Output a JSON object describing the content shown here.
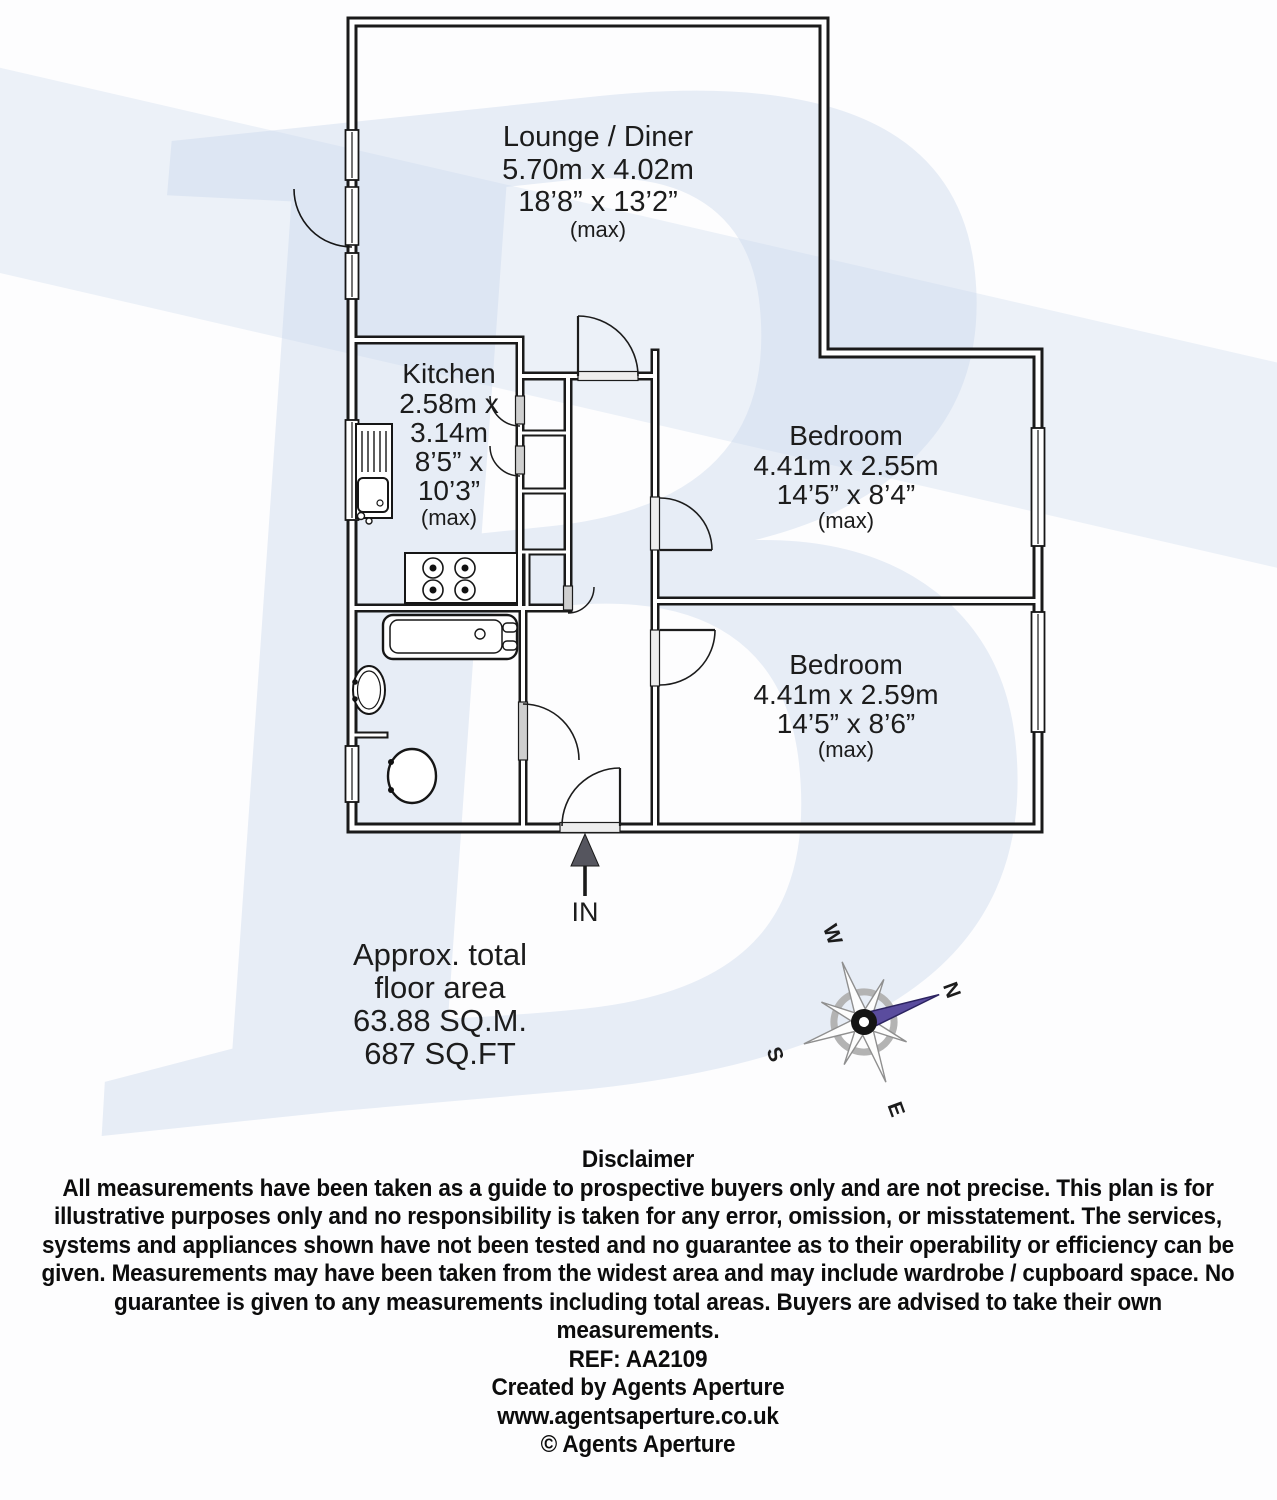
{
  "watermark": {
    "letter": "B"
  },
  "plan": {
    "rooms": {
      "lounge": {
        "name": "Lounge / Diner",
        "metric": "5.70m x 4.02m",
        "imperial": "18’8” x 13’2”",
        "max": "(max)"
      },
      "kitchen": {
        "name": "Kitchen",
        "metric_1": "2.58m x",
        "metric_2": "3.14m",
        "imperial_1": "8’5” x",
        "imperial_2": "10’3”",
        "max": "(max)"
      },
      "bedroom1": {
        "name": "Bedroom",
        "metric": "4.41m x 2.55m",
        "imperial": "14’5” x 8’4”",
        "max": "(max)"
      },
      "bedroom2": {
        "name": "Bedroom",
        "metric": "4.41m x 2.59m",
        "imperial": "14’5” x 8’6”",
        "max": "(max)"
      }
    },
    "entrance_label": "IN",
    "area": {
      "line1": "Approx. total",
      "line2": "floor area",
      "line3": "63.88 SQ.M.",
      "line4": "687 SQ.FT"
    },
    "compass": {
      "n": "N",
      "e": "E",
      "s": "S",
      "w": "W"
    }
  },
  "colors": {
    "wall": "#1a1a1a",
    "watermark_blue": "#c9d6eb",
    "compass_needle": "#5a4c9e",
    "door_leaf_gray": "#cfcfcf"
  },
  "disclaimer": {
    "title": "Disclaimer",
    "body": "All measurements have been taken as a guide to prospective buyers only and are not precise. This plan is for illustrative purposes only and no responsibility is taken for any error, omission, or misstatement. The services, systems and appliances shown have not been tested and no guarantee as to their operability or efficiency can be given. Measurements may have been taken from the widest area and may include wardrobe / cupboard space. No guarantee is given to any measurements including total areas. Buyers are advised to take their own measurements.",
    "ref": "REF: AA2109",
    "created_by": "Created by Agents Aperture",
    "website": "www.agentsaperture.co.uk",
    "copyright": "© Agents Aperture"
  }
}
